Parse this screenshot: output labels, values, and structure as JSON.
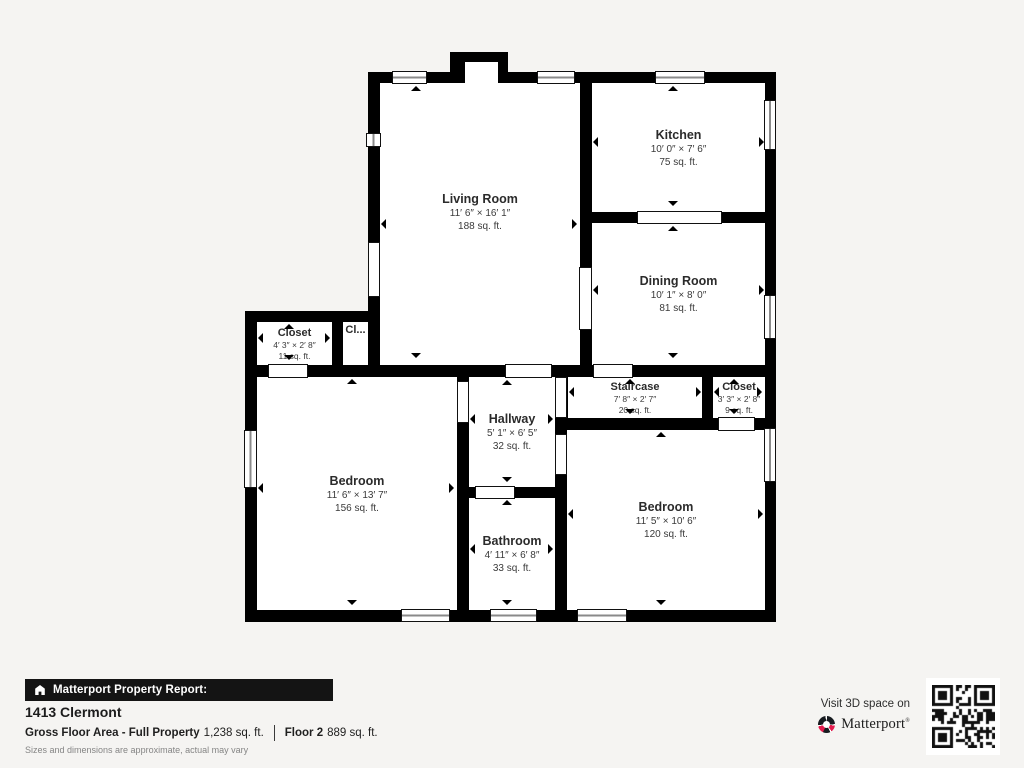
{
  "plan": {
    "rooms": {
      "living": {
        "name": "Living Room",
        "dims": "11′ 6″ × 16′ 1″",
        "area": "188 sq. ft."
      },
      "kitchen": {
        "name": "Kitchen",
        "dims": "10′ 0″ × 7′ 6″",
        "area": "75 sq. ft."
      },
      "dining": {
        "name": "Dining Room",
        "dims": "10′ 1″ × 8′ 0″",
        "area": "81 sq. ft."
      },
      "closet_left": {
        "name": "Closet",
        "dims": "4′ 3″ × 2′ 8″",
        "area": "11 sq. ft."
      },
      "closet_small": {
        "name": "Cl..."
      },
      "hallway": {
        "name": "Hallway",
        "dims": "5′ 1″ × 6′ 5″",
        "area": "32 sq. ft."
      },
      "staircase": {
        "name": "Staircase",
        "dims": "7′ 8″ × 2′ 7″",
        "area": "20 sq. ft."
      },
      "closet_right": {
        "name": "Closet",
        "dims": "3′ 3″ × 2′ 8″",
        "area": "9 sq. ft."
      },
      "bedroom_left": {
        "name": "Bedroom",
        "dims": "11′ 6″ × 13′ 7″",
        "area": "156 sq. ft."
      },
      "bathroom": {
        "name": "Bathroom",
        "dims": "4′ 11″ × 6′ 8″",
        "area": "33 sq. ft."
      },
      "bedroom_right": {
        "name": "Bedroom",
        "dims": "11′ 5″ × 10′ 6″",
        "area": "120 sq. ft."
      }
    }
  },
  "footer": {
    "report_label": "Matterport Property Report:",
    "address": "1413 Clermont",
    "gross_label": "Gross Floor Area - Full Property",
    "gross_value": "1,238 sq. ft.",
    "floor_label": "Floor 2",
    "floor_value": "889 sq. ft.",
    "disclaimer": "Sizes and dimensions are approximate, actual may vary",
    "visit_text": "Visit 3D space on",
    "brand": "Matterport",
    "brand_mark": "®"
  },
  "icons": {
    "report_icon": "house-icon",
    "brand_icon": "matterport-pinwheel-icon",
    "qr": "qr-code"
  },
  "colors": {
    "wall": "#000000",
    "background": "#f5f4f2",
    "accent_red": "#e31b4d",
    "footer_bar": "#141414"
  }
}
